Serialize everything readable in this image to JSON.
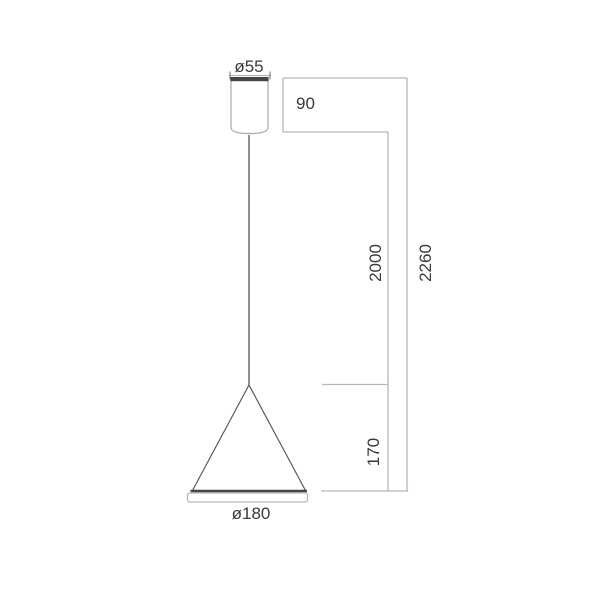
{
  "drawing": {
    "labels": {
      "canopy_diameter": "ø55",
      "canopy_height": "90",
      "suspension_length": "2000",
      "overall_height": "2260",
      "shade_height": "170",
      "shade_diameter": "ø180"
    },
    "colors": {
      "background": "#ffffff",
      "text": "#3a3a3a",
      "dimension_line": "#b4b8ba",
      "tick_line": "#6f6f6f",
      "object_line": "#a9a9a9",
      "cone_line": "#585858",
      "dark_line": "#454545",
      "cord": "#838383"
    }
  }
}
